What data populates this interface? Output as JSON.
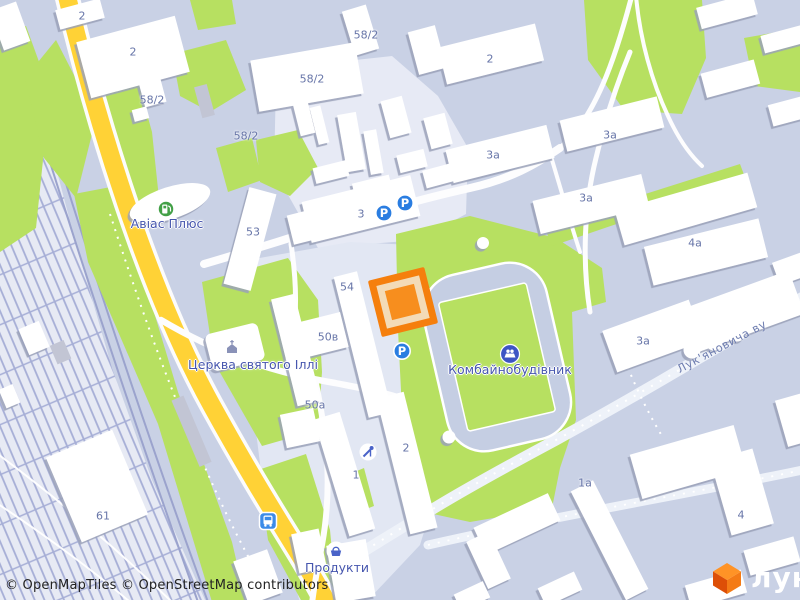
{
  "map": {
    "attribution": "© OpenMapTiles © OpenStreetMap contributors",
    "logo": {
      "text": "лун"
    },
    "street": {
      "name": "Лук'яновича ву"
    },
    "icons": {
      "parking_letter": "P"
    },
    "building_labels": [
      {
        "text": "2"
      },
      {
        "text": "2"
      },
      {
        "text": "58/2"
      },
      {
        "text": "2"
      },
      {
        "text": "58/2"
      },
      {
        "text": "58/2"
      },
      {
        "text": "58/2"
      },
      {
        "text": "3а"
      },
      {
        "text": "3а"
      },
      {
        "text": "3а"
      },
      {
        "text": "3"
      },
      {
        "text": "53"
      },
      {
        "text": "4а"
      },
      {
        "text": "54"
      },
      {
        "text": "50в"
      },
      {
        "text": "3а"
      },
      {
        "text": "50а"
      },
      {
        "text": "2"
      },
      {
        "text": "1"
      },
      {
        "text": "1а"
      },
      {
        "text": "4"
      },
      {
        "text": "61"
      }
    ],
    "poi_labels": [
      {
        "text": "Авіас Плюс"
      },
      {
        "text": "Церква святого Іллі"
      },
      {
        "text": "Комбайнобудівник"
      },
      {
        "text": "Продукти"
      }
    ],
    "colors": {
      "base": "#c9d1e5",
      "green": "#b7e061",
      "rail_bg": "#e7eaf4",
      "rail_line": "#a6aed6",
      "plot_light": "#e7eaf5",
      "plot_block": "#e2e7f3",
      "road_yellow": "#ffd236",
      "road_white": "#fdfdfe",
      "building": "#ffffff",
      "building_gray": "#c2c5d4",
      "stadium_track": "#c5cee3",
      "marker_border": "#f57f0d",
      "marker_ring": "#f3dbb7",
      "marker_core": "#f78e1e",
      "icon_blue": "#2a7de1",
      "icon_indigo": "#3d55c4",
      "icon_green": "#43a047",
      "label_number": "#6775a8",
      "label_poi": "#4656ae",
      "label_street": "#6e7db0",
      "logo_orange": "#f47b16"
    }
  }
}
